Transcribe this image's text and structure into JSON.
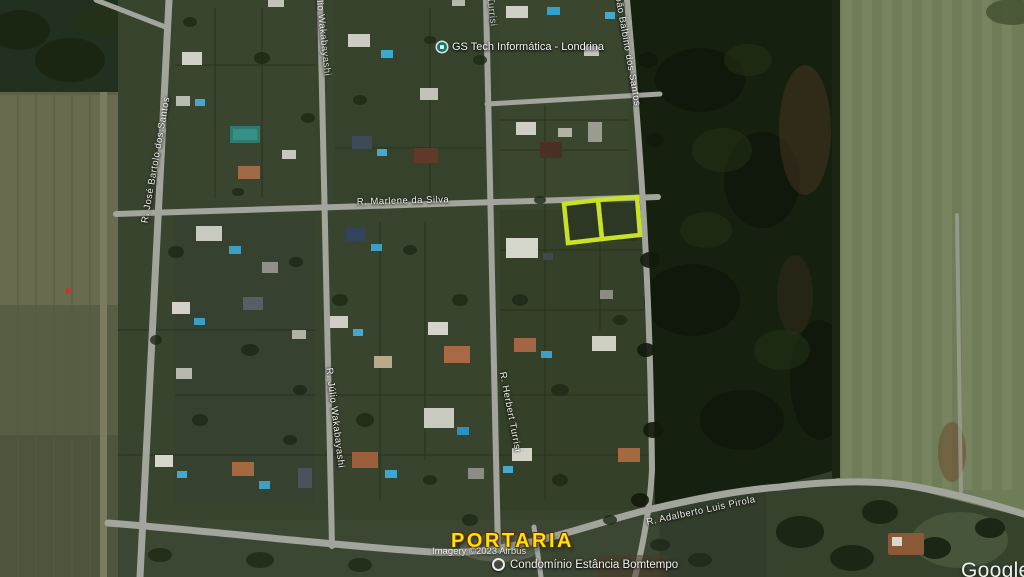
{
  "poi": {
    "gs_tech": {
      "label": "GS Tech Informática - Londrina"
    },
    "gate": {
      "label": "PORTARIA"
    },
    "condominium": {
      "label": "Condomínio Estância Bomtempo"
    }
  },
  "streets": [
    {
      "id": "marlene",
      "label": "R. Marlene da Silva"
    },
    {
      "id": "julio",
      "label": "R. Júlio Wakabayashi"
    },
    {
      "id": "herbert",
      "label": "R. Herbert Turrisi"
    },
    {
      "id": "balbino",
      "label": "R. João Balbino dos Santos"
    },
    {
      "id": "jose",
      "label": "R. José Bartolo dos Santos"
    },
    {
      "id": "adalberto",
      "label": "R. Adalberto Luis Pirola"
    }
  ],
  "highlight": {
    "color": "#c9e227",
    "lots": [
      {
        "points": "564,204 598,200 602,239 568,243"
      },
      {
        "points": "598,200 637,197 640,235 602,239"
      }
    ]
  },
  "attribution": {
    "imagery": "Imagery ©2023 Airbus",
    "brand": "Google"
  }
}
